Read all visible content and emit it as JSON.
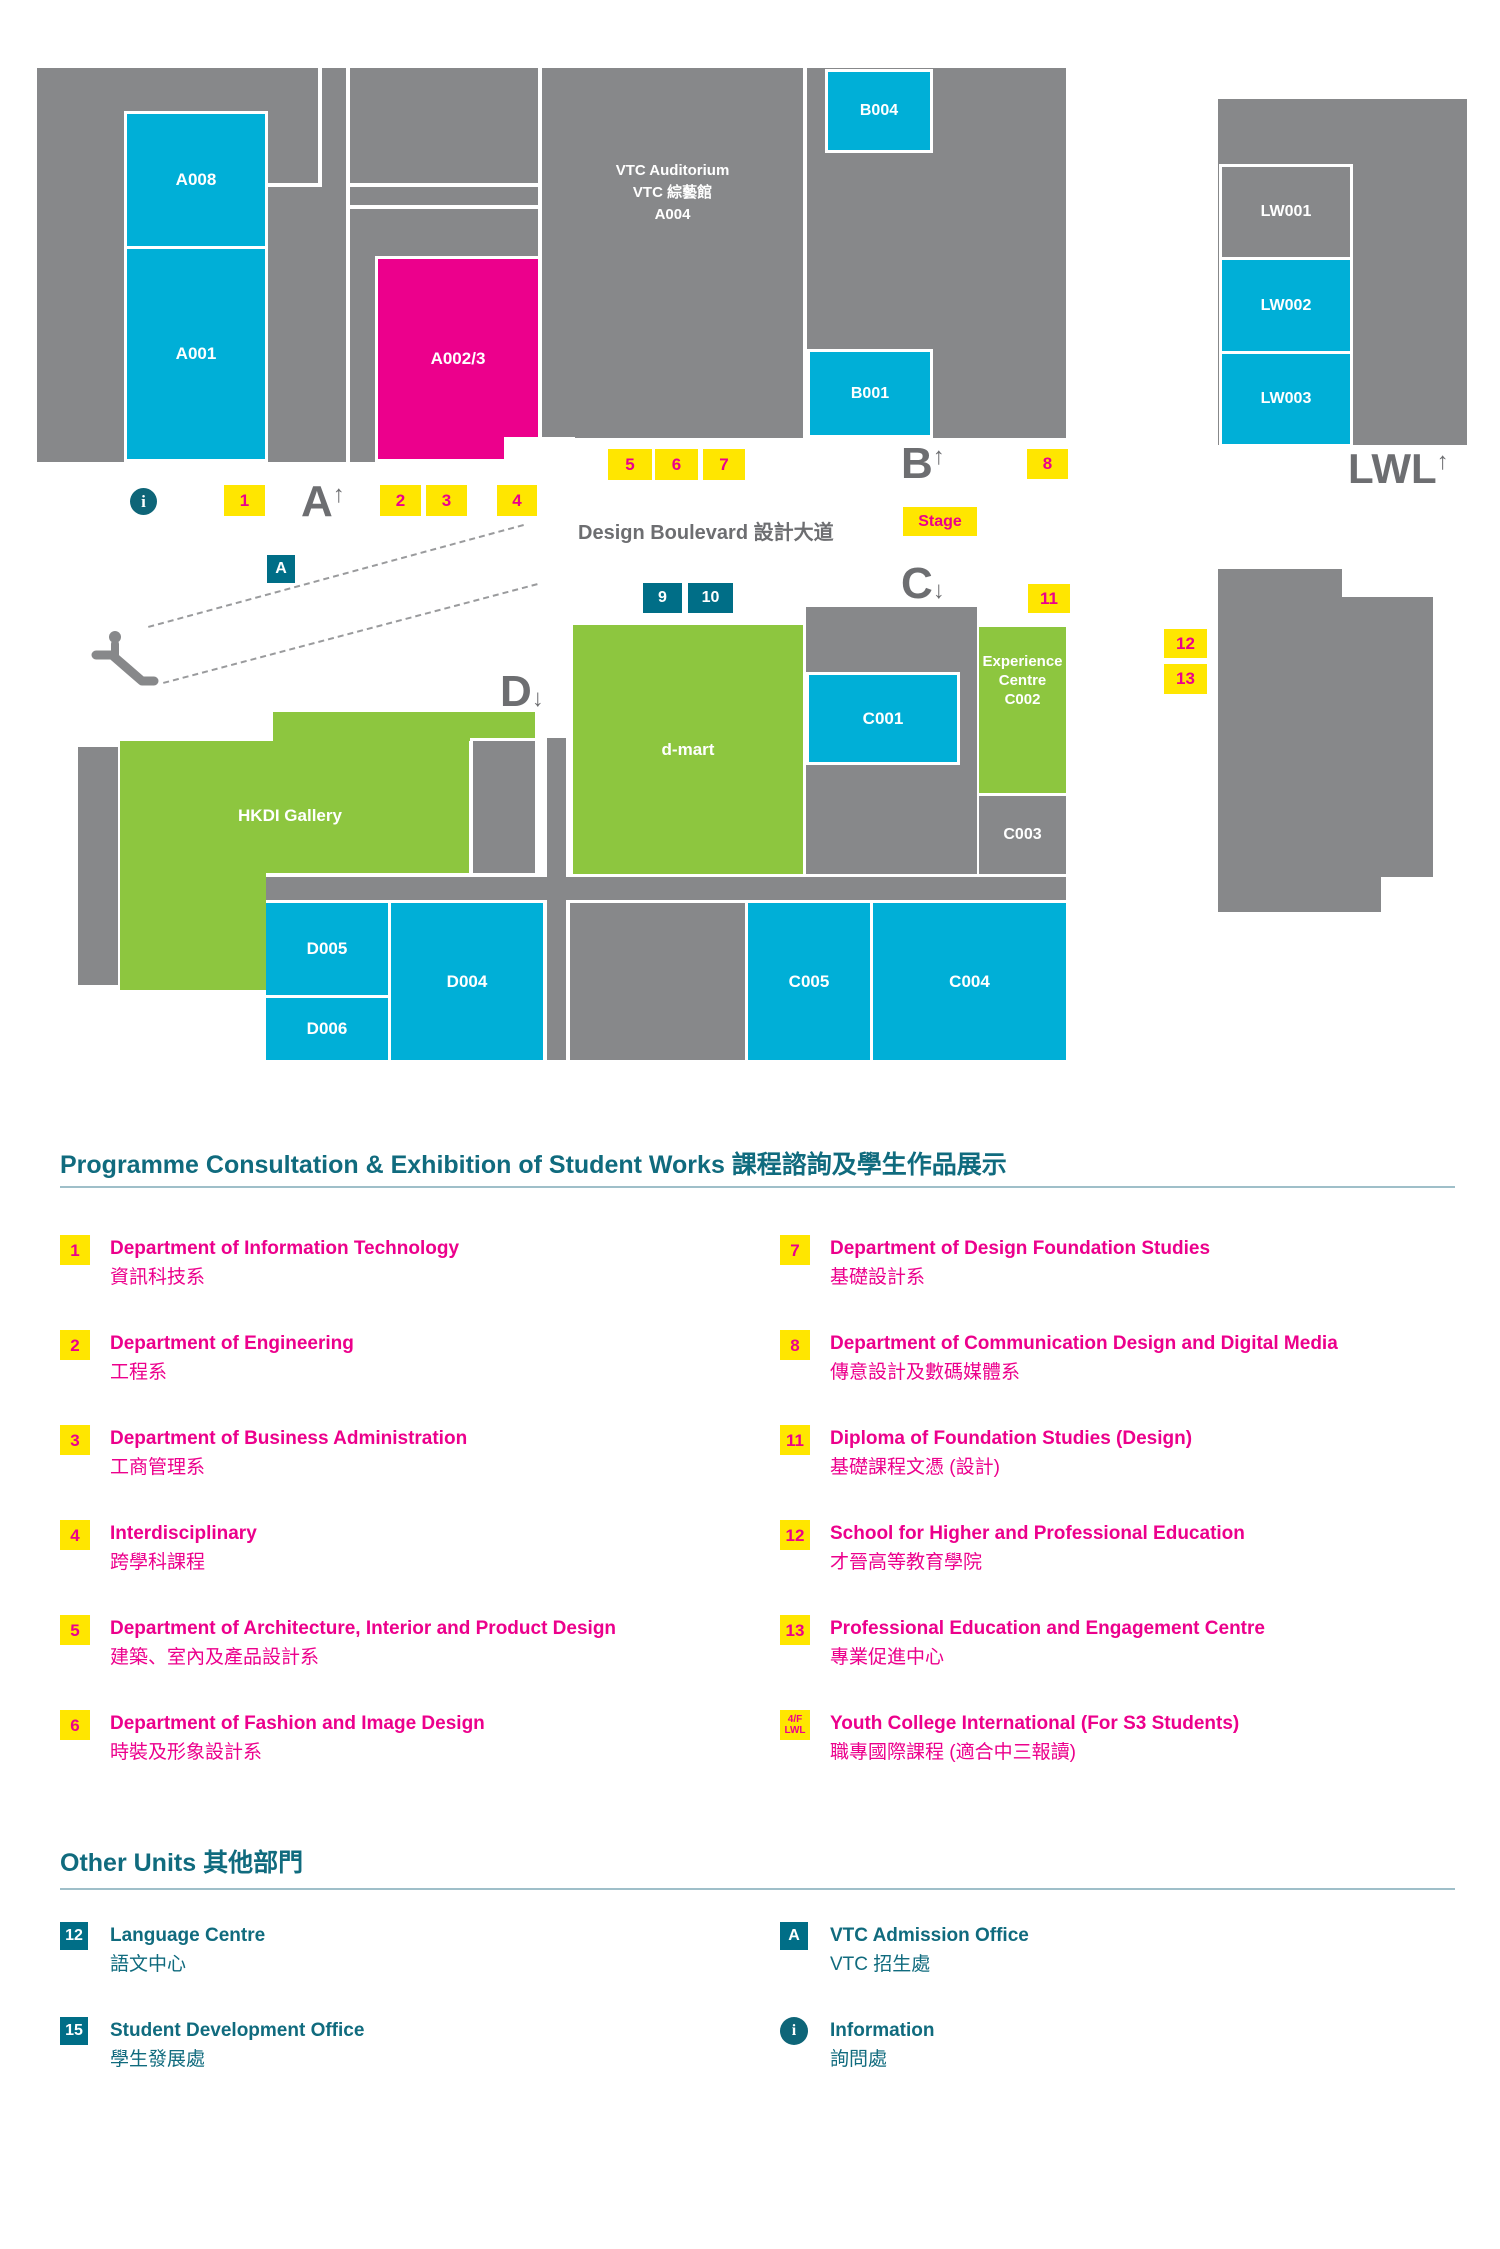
{
  "colors": {
    "cyan_room": "#00AFD7",
    "green_room": "#8DC63F",
    "magenta_room": "#EC008C",
    "gray_room": "#87888A",
    "marker_yellow": "#FFE600",
    "marker_magenta_text": "#EC008C",
    "teal_badge": "#006E87",
    "teal_heading": "#106B7E",
    "letter_gray": "#6D6E71"
  },
  "map": {
    "rooms": {
      "a008": "A008",
      "a001": "A001",
      "a0023": "A002/3",
      "auditorium": [
        "VTC Auditorium",
        "VTC 綜藝館",
        "A004"
      ],
      "b004": "B004",
      "b001": "B001",
      "lw001": "LW001",
      "lw002": "LW002",
      "lw003": "LW003",
      "dmart": "d-mart",
      "gallery": "HKDI Gallery",
      "c001": "C001",
      "c002": [
        "Experience",
        "Centre",
        "C002"
      ],
      "c003": "C003",
      "c004": "C004",
      "c005": "C005",
      "d004": "D004",
      "d005": "D005",
      "d006": "D006"
    },
    "markers": {
      "m1": "1",
      "m2": "2",
      "m3": "3",
      "m4": "4",
      "m5": "5",
      "m6": "6",
      "m7": "7",
      "m8": "8",
      "m9": "9",
      "m10": "10",
      "m11": "11",
      "m12": "12",
      "m13": "13",
      "a_badge": "A",
      "stage": "Stage",
      "info": "i"
    },
    "letters": {
      "a": "A",
      "b": "B",
      "c": "C",
      "d": "D",
      "lwl": "LWL",
      "up": "↑",
      "down": "↓"
    },
    "boulevard": "Design Boulevard 設計大道"
  },
  "legend": {
    "section1": {
      "title": "Programme Consultation & Exhibition of Student Works 課程諮詢及學生作品展示",
      "left": [
        {
          "badge": "1",
          "badge_style": "yellow",
          "en": "Department of Information Technology",
          "zh": "資訊科技系"
        },
        {
          "badge": "2",
          "badge_style": "yellow",
          "en": "Department of Engineering",
          "zh": "工程系"
        },
        {
          "badge": "3",
          "badge_style": "yellow",
          "en": "Department of Business Administration",
          "zh": "工商管理系"
        },
        {
          "badge": "4",
          "badge_style": "yellow",
          "en": "Interdisciplinary",
          "zh": "跨學科課程"
        },
        {
          "badge": "5",
          "badge_style": "yellow",
          "en": "Department of Architecture, Interior and Product Design",
          "zh": "建築、室內及產品設計系"
        },
        {
          "badge": "6",
          "badge_style": "yellow",
          "en": "Department of Fashion and Image Design",
          "zh": "時裝及形象設計系"
        }
      ],
      "right": [
        {
          "badge": "7",
          "badge_style": "yellow",
          "en": "Department of Design Foundation Studies",
          "zh": "基礎設計系"
        },
        {
          "badge": "8",
          "badge_style": "yellow",
          "en": "Department of Communication Design and Digital Media",
          "zh": "傳意設計及數碼媒體系"
        },
        {
          "badge": "11",
          "badge_style": "yellow",
          "en": "Diploma of Foundation Studies (Design)",
          "zh": "基礎課程文憑 (設計)"
        },
        {
          "badge": "12",
          "badge_style": "yellow",
          "en": "School for Higher and Professional Education",
          "zh": "才晉高等教育學院"
        },
        {
          "badge": "13",
          "badge_style": "yellow",
          "en": "Professional Education and Engagement Centre",
          "zh": "專業促進中心"
        },
        {
          "badge": "4/F LWL",
          "badge_lines": [
            "4/F",
            "LWL"
          ],
          "badge_style": "yellow",
          "en": "Youth College International (For S3 Students)",
          "zh": "職專國際課程 (適合中三報讀)"
        }
      ]
    },
    "section2": {
      "title": "Other Units 其他部門",
      "left": [
        {
          "badge": "12",
          "badge_style": "teal",
          "en": "Language Centre",
          "zh": "語文中心"
        },
        {
          "badge": "15",
          "badge_style": "teal",
          "en": "Student Development Office",
          "zh": "學生發展處"
        }
      ],
      "right": [
        {
          "badge": "A",
          "badge_style": "teal",
          "en": "VTC Admission Office",
          "zh": "VTC 招生處"
        },
        {
          "badge": "i",
          "badge_style": "teal-circle",
          "en": "Information",
          "zh": "詢問處"
        }
      ]
    }
  }
}
